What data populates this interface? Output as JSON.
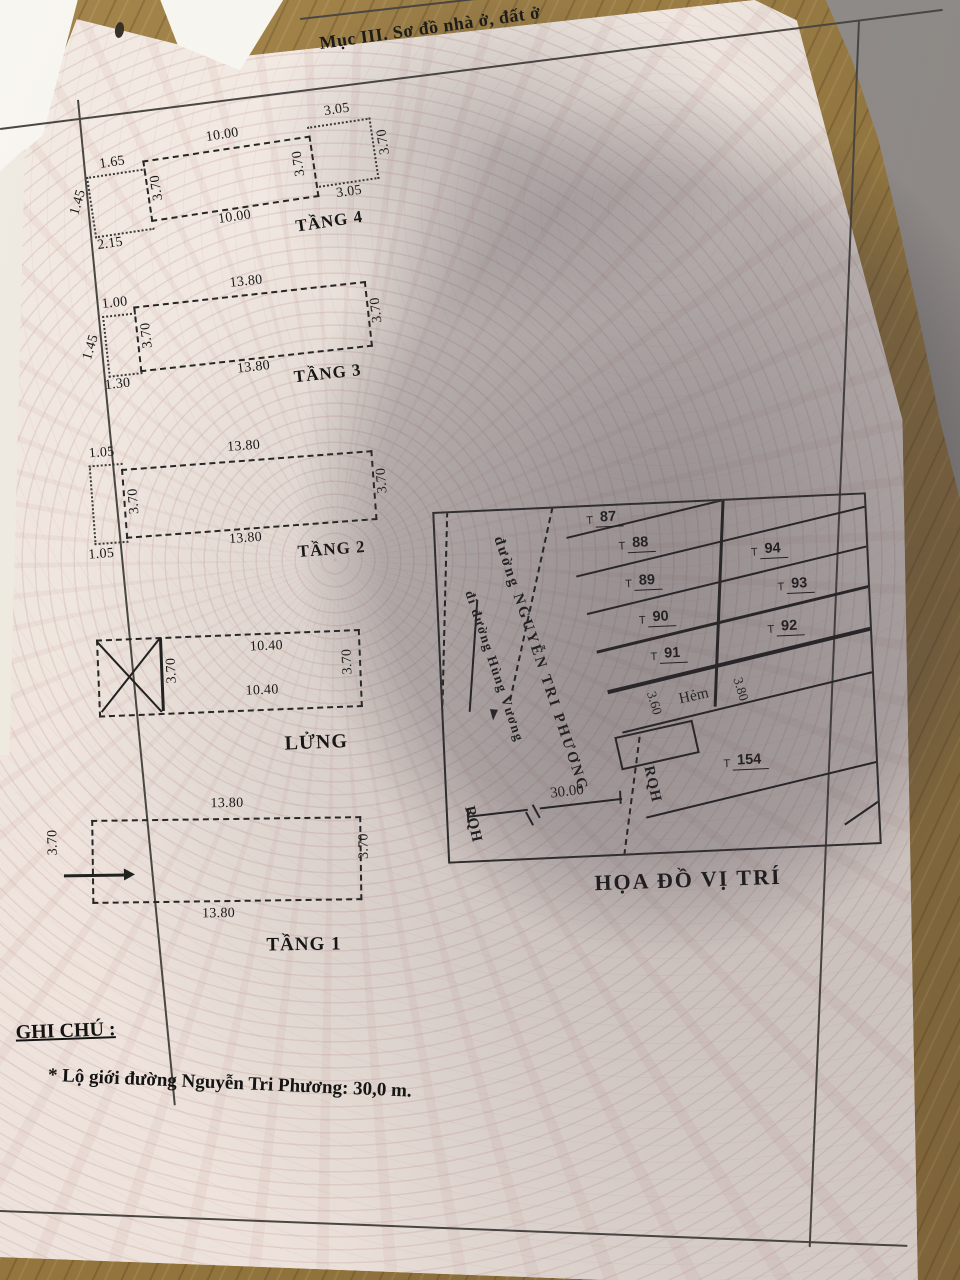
{
  "header": {
    "title": "Mục III. Sơ đồ nhà ở, đất ở"
  },
  "floors": [
    {
      "id": "tang4",
      "label": "TẦNG 4",
      "dims": {
        "top": "10.00",
        "bottom": "10.00",
        "left": "3.70",
        "right": "3.70"
      },
      "left_ext": {
        "top": "1.65",
        "side": "1.45",
        "bottom": "2.15"
      },
      "right_ext": {
        "top": "3.05",
        "side": "3.70",
        "bottom": "3.05"
      }
    },
    {
      "id": "tang3",
      "label": "TẦNG 3",
      "dims": {
        "top": "13.80",
        "bottom": "13.80",
        "left": "3.70",
        "right": "3.70"
      },
      "left_ext": {
        "top": "1.00",
        "side": "1.45",
        "bottom": "1.30"
      }
    },
    {
      "id": "tang2",
      "label": "TẦNG 2",
      "dims": {
        "top": "13.80",
        "bottom": "13.80",
        "left": "3.70",
        "right": "3.70"
      },
      "left_ext": {
        "top": "1.05",
        "bottom": "1.05"
      }
    },
    {
      "id": "lung",
      "label": "LỬNG",
      "dims": {
        "top": "10.40",
        "mid": "10.40",
        "divider": "3.70",
        "right": "3.70"
      }
    },
    {
      "id": "tang1",
      "label": "TẦNG 1",
      "dims": {
        "top": "13.80",
        "bottom": "13.80",
        "left": "3.70",
        "right": "3.70"
      }
    }
  ],
  "map": {
    "title": "HỌA ĐỒ VỊ TRÍ",
    "street_name": "đường NGUYỄN TRI PHƯƠNG",
    "street_direction": "đi đường Hùng Vương",
    "road_width": "30.00",
    "boundary_left": "RQH",
    "boundary_right": "RQH",
    "alley_label": "Hẻm",
    "alley_width_left": "3.60",
    "alley_width_right": "3.80",
    "lots": [
      {
        "prefix": "T",
        "num": "87"
      },
      {
        "prefix": "T",
        "num": "88"
      },
      {
        "prefix": "T",
        "num": "89"
      },
      {
        "prefix": "T",
        "num": "90"
      },
      {
        "prefix": "T",
        "num": "91"
      },
      {
        "prefix": "T",
        "num": "94"
      },
      {
        "prefix": "T",
        "num": "93"
      },
      {
        "prefix": "T",
        "num": "92"
      },
      {
        "prefix": "T",
        "num": "154"
      }
    ]
  },
  "notes": {
    "heading": "GHI CHÚ :",
    "items": [
      "* Lộ giới đường Nguyễn Tri Phương: 30,0 m."
    ]
  },
  "colors": {
    "paper": "#efe6df",
    "ink": "#1d1d1b",
    "wood": "#97793f",
    "shadow": "#38323c"
  }
}
